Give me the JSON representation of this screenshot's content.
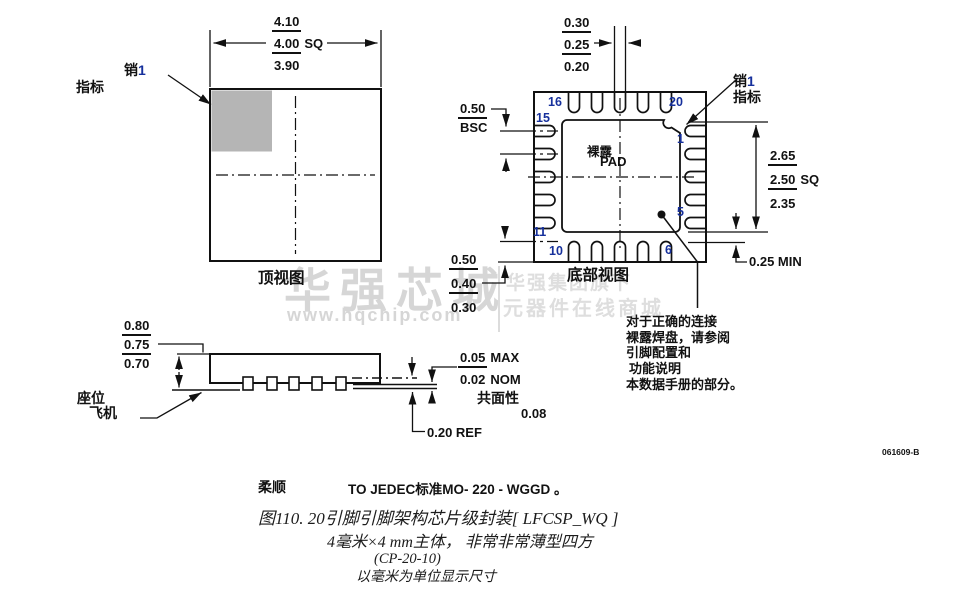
{
  "watermark": {
    "brand": "华强芯城",
    "url": "www.hqchip.com",
    "company": "华强集团旗下",
    "tagline": "元器件在线商城"
  },
  "doc_number": "061609-B",
  "top_view": {
    "title": "顶视图",
    "pin1_cn": "销",
    "pin1_num": "1",
    "pin1_line2": "指标",
    "dim_a": "4.10",
    "dim_b": "4.00",
    "dim_b_sfx": "SQ",
    "dim_c": "3.90"
  },
  "bottom_view": {
    "title": "底部视图",
    "pad_line1": "裸露",
    "pad_line2": "PAD",
    "pin1_cn": "销",
    "pin1_num": "1",
    "pin1_line2": "指标",
    "lead_width": {
      "a": "0.30",
      "b": "0.25",
      "c": "0.20"
    },
    "pitch": {
      "a": "0.50",
      "b": "BSC"
    },
    "pad_size": {
      "a": "2.65",
      "b": "2.50",
      "b_sfx": "SQ",
      "c": "2.35"
    },
    "lead_length": {
      "a": "0.50",
      "b": "0.40",
      "c": "0.30"
    },
    "clearance": "0.25 MIN",
    "pins": {
      "n16": "16",
      "n20": "20",
      "n15": "15",
      "n11": "11",
      "n10": "10",
      "n6": "6",
      "n1": "1",
      "n5": "5"
    }
  },
  "side_view": {
    "height": {
      "a": "0.80",
      "b": "0.75",
      "c": "0.70"
    },
    "seating_line1": "座位",
    "seating_line2": "飞机",
    "thickness": {
      "a": "0.05",
      "a_sfx": "MAX",
      "b": "0.02",
      "b_sfx": "NOM"
    },
    "coplanarity_label": "共面性",
    "coplanarity_value": "0.08",
    "lead_ref": "0.20 REF"
  },
  "note": {
    "line1": "对于正确的连接",
    "line2": "裸露焊盘，请参阅",
    "line3": "引脚配置和",
    "line4": "功能说明",
    "line5": "本数据手册的部分。"
  },
  "footer": {
    "compliance_label": "柔顺",
    "compliance_text": "TO JEDEC标准MO- 220 - WGGD 。",
    "caption1": "图110. 20引脚引脚架构芯片级封装[ LFCSP_WQ ]",
    "caption2": "4毫米×4 mm主体， 非常非常薄型四方",
    "caption3": "(CP-20-10)",
    "caption4": "以毫米为单位显示尺寸"
  }
}
